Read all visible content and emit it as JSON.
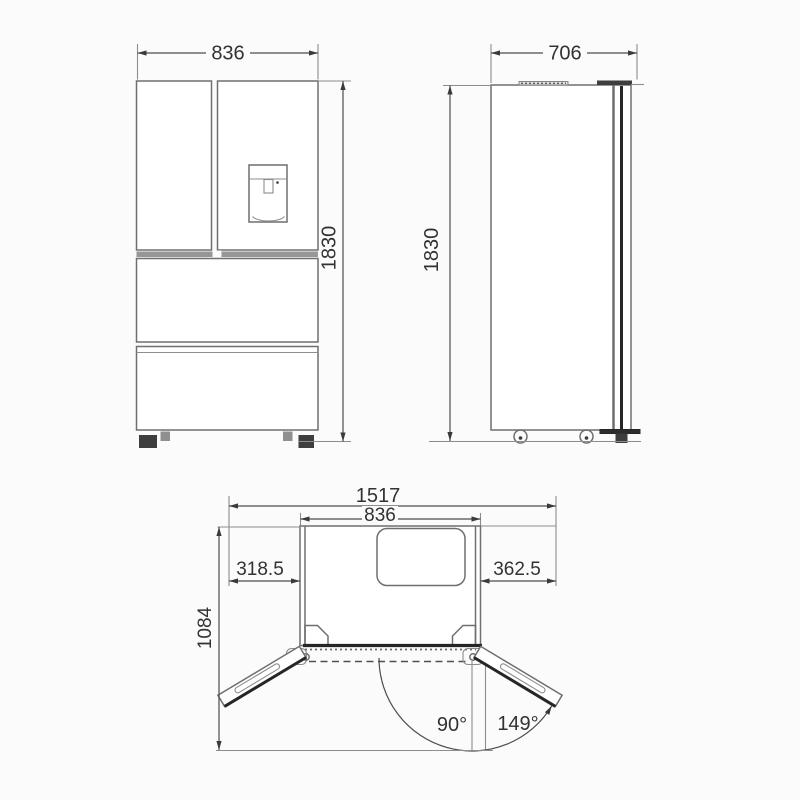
{
  "diagram": {
    "kind": "refrigerator dimension drawing",
    "views": [
      "front",
      "side",
      "top-doors-open"
    ]
  },
  "views": {
    "front": {
      "width": "836",
      "height": "1830"
    },
    "side": {
      "depth": "706",
      "height": "1830"
    },
    "top": {
      "overall_width": "1517",
      "cabinet_width": "836",
      "left_offset": "318.5",
      "right_offset": "362.5",
      "depth": "1084",
      "angle_90": "90°",
      "angle_149": "149°"
    }
  }
}
